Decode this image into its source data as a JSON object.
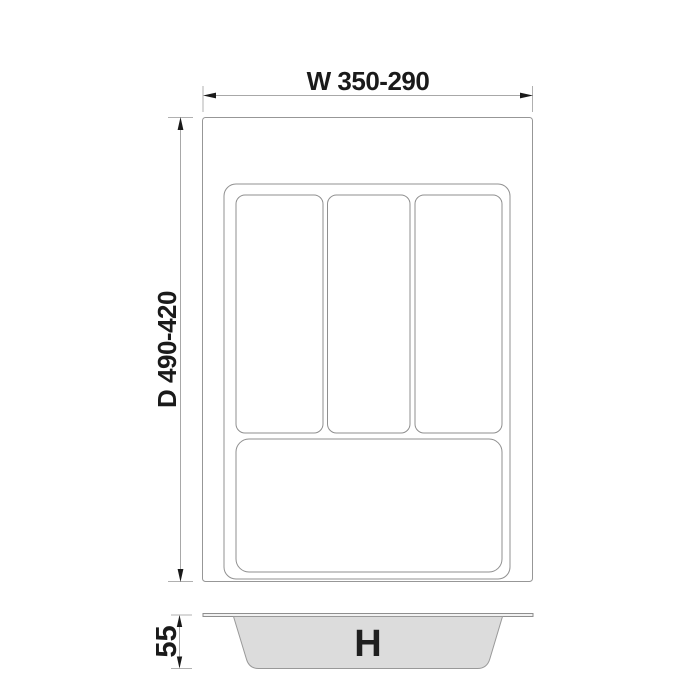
{
  "top_view": {
    "width_dimension_label": "W 350-290",
    "depth_dimension_label": "D 490-420"
  },
  "side_view": {
    "height_dimension_label": "55",
    "height_variable_label": "H"
  },
  "colors": {
    "outline": "#979797",
    "dimension_line": "#a8a8a8",
    "text": "#1a1a1a",
    "tray_fill": "#dcdcdc",
    "background": "#ffffff"
  }
}
